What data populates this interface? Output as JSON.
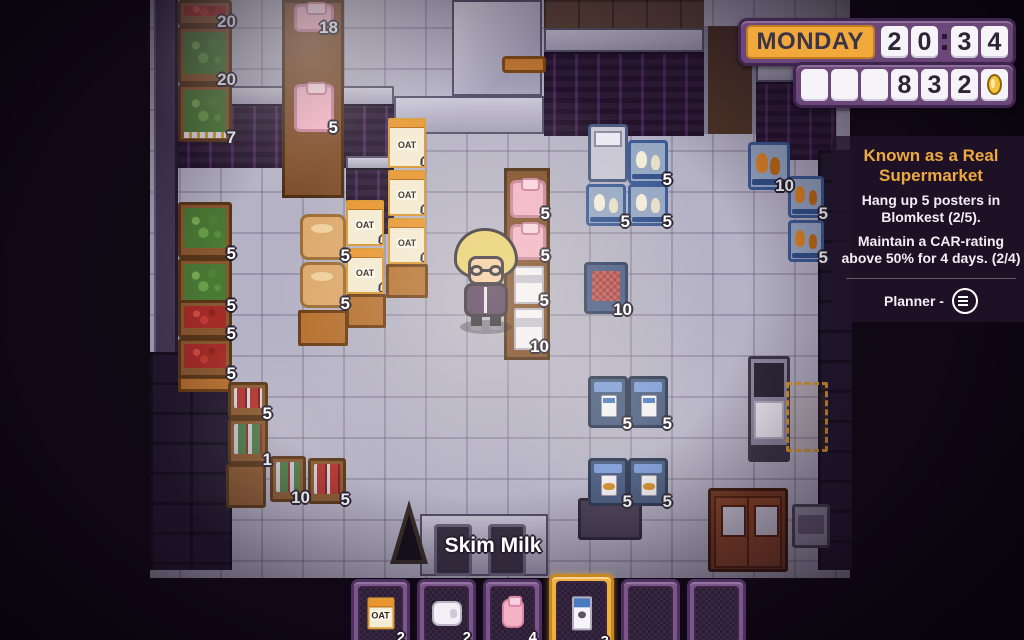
{
  "hud": {
    "day": "MONDAY",
    "time": {
      "h1": "2",
      "h2": "0",
      "m1": "3",
      "m2": "4"
    },
    "money_cells": [
      "",
      "",
      "",
      "8",
      "3",
      "2"
    ],
    "coin_icon": "gold-coin"
  },
  "quest": {
    "title": "Known as a Real Supermarket",
    "tasks": [
      "Hang up 5 posters in Blomkest (2/5).",
      "Maintain a CAR-rating above 50% for 4 days. (2/4)"
    ],
    "planner_label": "Planner -",
    "planner_icon": "circle-menu"
  },
  "world": {
    "item_label": "Skim Milk",
    "oat_label": "OAT",
    "stock": [
      {
        "item": "tomatoes",
        "count": "20"
      },
      {
        "item": "lettuce",
        "count": "20"
      },
      {
        "item": "lettuce",
        "count": "7"
      },
      {
        "item": "pink-pastry",
        "count": "18"
      },
      {
        "item": "pink-pastry",
        "count": "5"
      },
      {
        "item": "lettuce",
        "count": "5"
      },
      {
        "item": "lettuce",
        "count": "5"
      },
      {
        "item": "apples",
        "count": "5"
      },
      {
        "item": "apples",
        "count": "5"
      },
      {
        "item": "bread",
        "count": "5"
      },
      {
        "item": "bread",
        "count": "5"
      },
      {
        "item": "oat-cereal",
        "count": "5"
      },
      {
        "item": "oat-cereal",
        "count": "5"
      },
      {
        "item": "oat-cereal",
        "count": "5"
      },
      {
        "item": "oat-cereal",
        "count": "5"
      },
      {
        "item": "oat-cereal",
        "count": "5"
      },
      {
        "item": "strawberry-jam",
        "count": "5"
      },
      {
        "item": "strawberry-jam",
        "count": "5"
      },
      {
        "item": "skim-milk",
        "count": "5"
      },
      {
        "item": "skim-milk",
        "count": "10"
      },
      {
        "item": "frozen-chicken",
        "count": "5"
      },
      {
        "item": "frozen-chicken",
        "count": "5"
      },
      {
        "item": "frozen-chicken",
        "count": "5"
      },
      {
        "item": "rotisserie-chicken",
        "count": "10"
      },
      {
        "item": "rotisserie-chicken",
        "count": "5"
      },
      {
        "item": "rotisserie-chicken",
        "count": "5"
      },
      {
        "item": "ground-meat",
        "count": "10"
      },
      {
        "item": "skim-milk-fridge",
        "count": "5"
      },
      {
        "item": "skim-milk-fridge",
        "count": "5"
      },
      {
        "item": "frozen-fish",
        "count": "5"
      },
      {
        "item": "frozen-fish",
        "count": "5"
      },
      {
        "item": "canned-soup",
        "count": "5"
      },
      {
        "item": "canned-goods",
        "count": "1"
      },
      {
        "item": "canned-goods",
        "count": "10"
      },
      {
        "item": "canned-soup",
        "count": "5"
      }
    ]
  },
  "hotbar": {
    "slots": [
      {
        "item": "oat-box",
        "count": "2",
        "selected": false
      },
      {
        "item": "toilet-paper",
        "count": "2",
        "selected": false
      },
      {
        "item": "strawberry-milk",
        "count": "4",
        "selected": false
      },
      {
        "item": "skim-milk",
        "count": "3",
        "selected": true
      },
      {
        "item": "empty",
        "count": "",
        "selected": false
      },
      {
        "item": "empty",
        "count": "",
        "selected": false
      }
    ]
  }
}
